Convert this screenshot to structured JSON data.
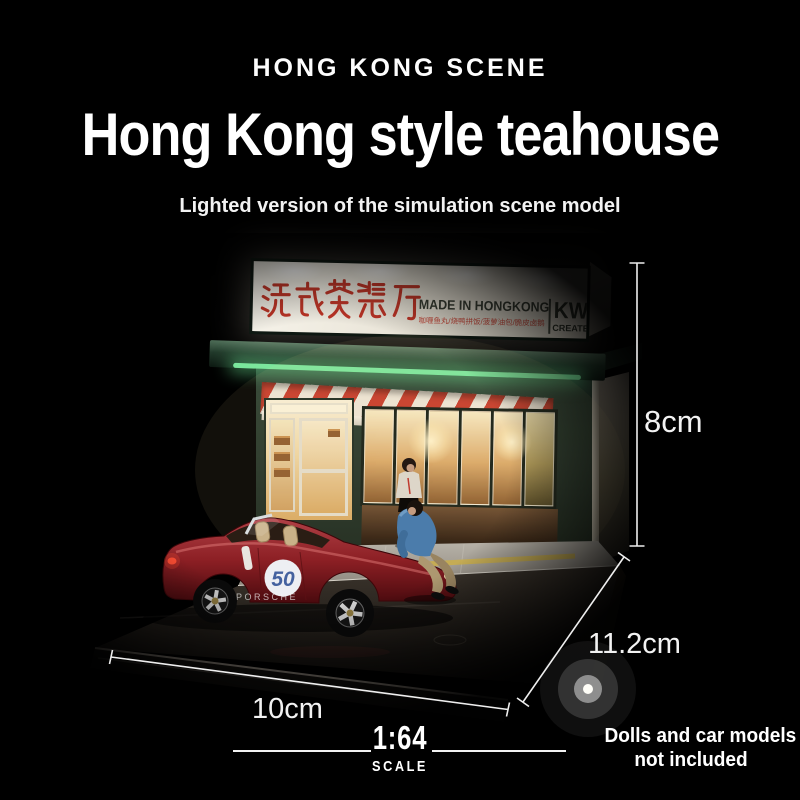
{
  "header": {
    "brand": "HONG KONG SCENE",
    "title": "Hong Kong style teahouse",
    "subtitle": "Lighted version of the simulation scene model"
  },
  "signboard": {
    "chinese_name": "港式茶餐厅",
    "made_in": "MADE IN HONGKONG",
    "menu_line": "咖喱鱼丸/烧鸭拼饭/菠萝油包/脆皮卤鹅",
    "maker_top": "KW",
    "maker_bottom": "CREATE"
  },
  "car": {
    "roundel_number": "50",
    "side_text": "PORSCHE"
  },
  "dimensions": {
    "height_label": "8cm",
    "depth_label": "11.2cm",
    "width_label": "10cm"
  },
  "scale_badge": {
    "ratio": "1:64",
    "label": "SCALE"
  },
  "disclaimer": {
    "line1": "Dolls and car models",
    "line2": "not included"
  },
  "colors": {
    "background": "#000000",
    "text": "#ffffff",
    "sign_red": "#c23a2c",
    "awning_red": "#c63b2b",
    "awning_white": "#ece4d6",
    "facade_green": "#243429",
    "glow_green": "#7ae69c",
    "window_warm": "#daa868",
    "car_red": "#8c1f24",
    "roundel_blue": "#44629f",
    "dimension_line": "#eeeeee"
  }
}
